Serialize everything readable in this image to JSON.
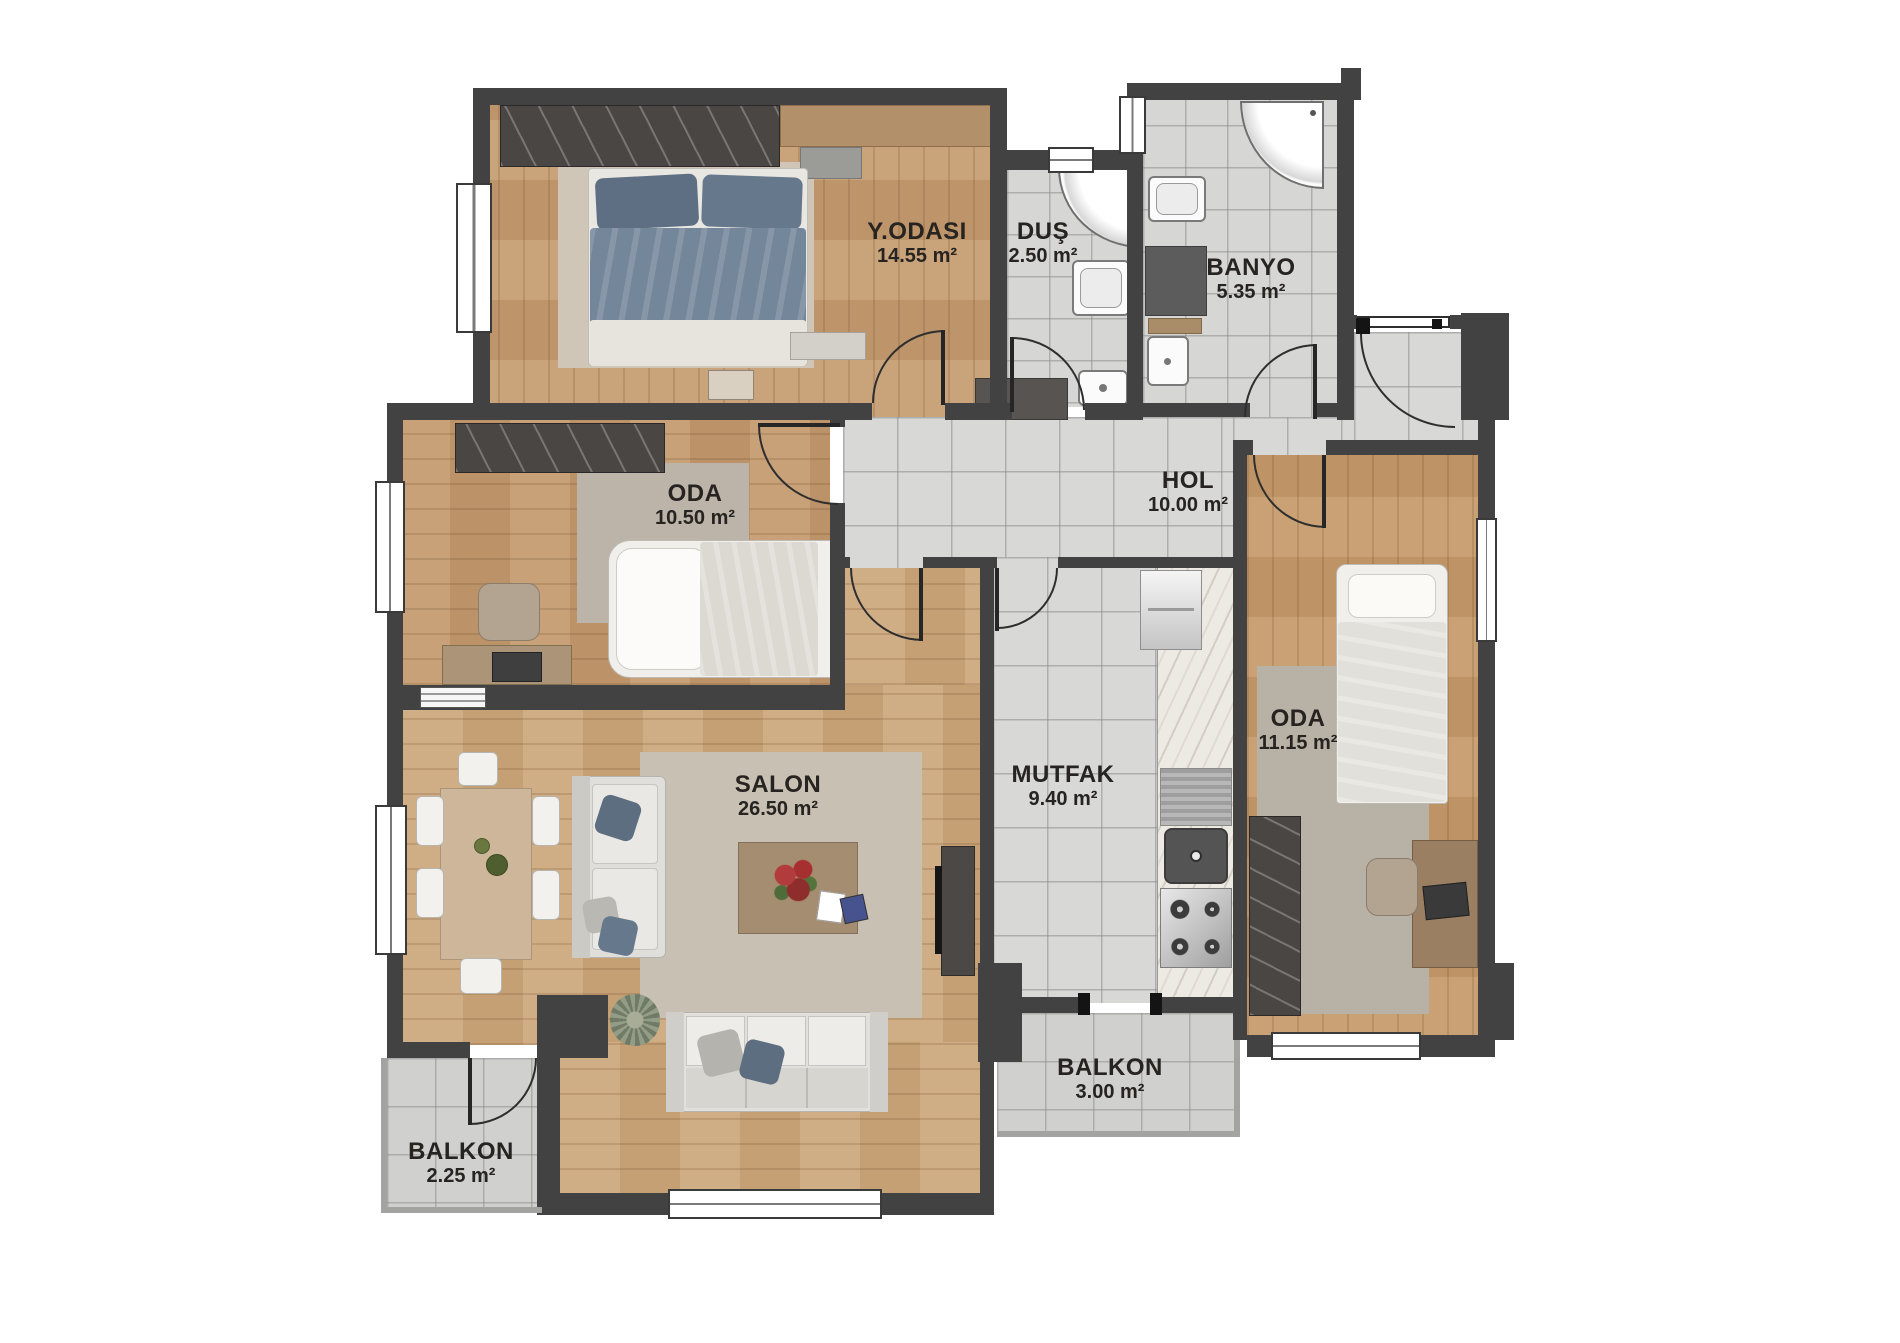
{
  "plan": {
    "title": "apartment-floor-plan",
    "rooms": [
      {
        "name": "Y.ODASI",
        "area": "14.55 m²"
      },
      {
        "name": "DUŞ",
        "area": "2.50 m²"
      },
      {
        "name": "BANYO",
        "area": "5.35 m²"
      },
      {
        "name": "HOL",
        "area": "10.00 m²"
      },
      {
        "name": "ODA",
        "area": "10.50 m²"
      },
      {
        "name": "SALON",
        "area": "26.50 m²"
      },
      {
        "name": "MUTFAK",
        "area": "9.40 m²"
      },
      {
        "name": "ODA",
        "area": "11.15 m²"
      },
      {
        "name": "BALKON",
        "area": "3.00 m²"
      },
      {
        "name": "BALKON",
        "area": "2.25 m²"
      }
    ],
    "colors": {
      "wall": "#424242",
      "wood": "#c79f74",
      "tile": "#d8d8d6",
      "label_text": "#262320"
    }
  }
}
